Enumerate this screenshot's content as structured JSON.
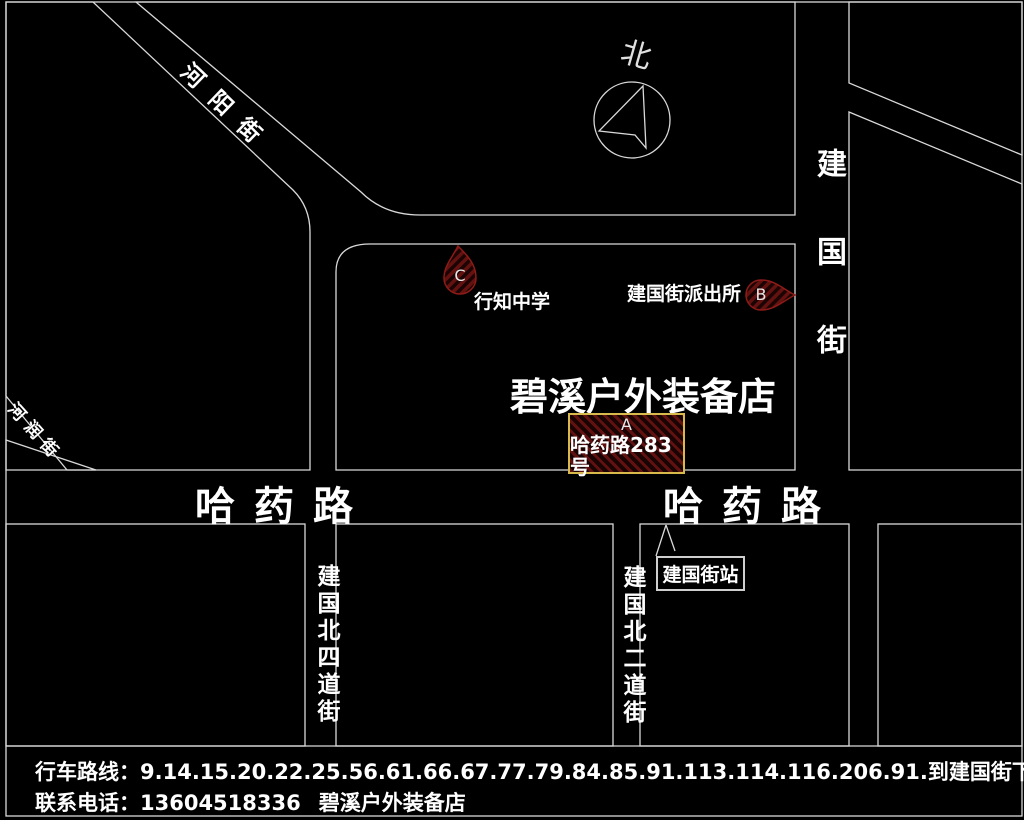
{
  "map": {
    "compass_label": "北",
    "streets": {
      "heyang": "河阳街",
      "herun": "河润街",
      "jianguo_vertical": "建国街",
      "hayao_left": "哈药路",
      "hayao_right": "哈药路",
      "jianguo_north_4th": "建国北四道街",
      "jianguo_north_2nd": "建国北二道街"
    },
    "markers": {
      "a": {
        "letter": "A",
        "label": "哈药路283号"
      },
      "b": {
        "letter": "B",
        "label": "建国街派出所"
      },
      "c": {
        "letter": "C",
        "label": "行知中学"
      }
    },
    "title": "碧溪户外装备店",
    "bus_stop": "建国街站"
  },
  "footer": {
    "line1": "行车路线：9.14.15.20.22.25.56.61.66.67.77.79.84.85.91.113.114.116.206.91.到建国街下车。哈药路283号。",
    "phone": "联系电话：13604518336",
    "shop": "碧溪户外装备店"
  },
  "colors": {
    "background": "#000000",
    "road_line": "#d9d9d9",
    "marker_hatch_red": "#601110",
    "marker_stroke": "#8d1b18",
    "a_box_border": "#d7b94c",
    "text": "#ffffff"
  }
}
